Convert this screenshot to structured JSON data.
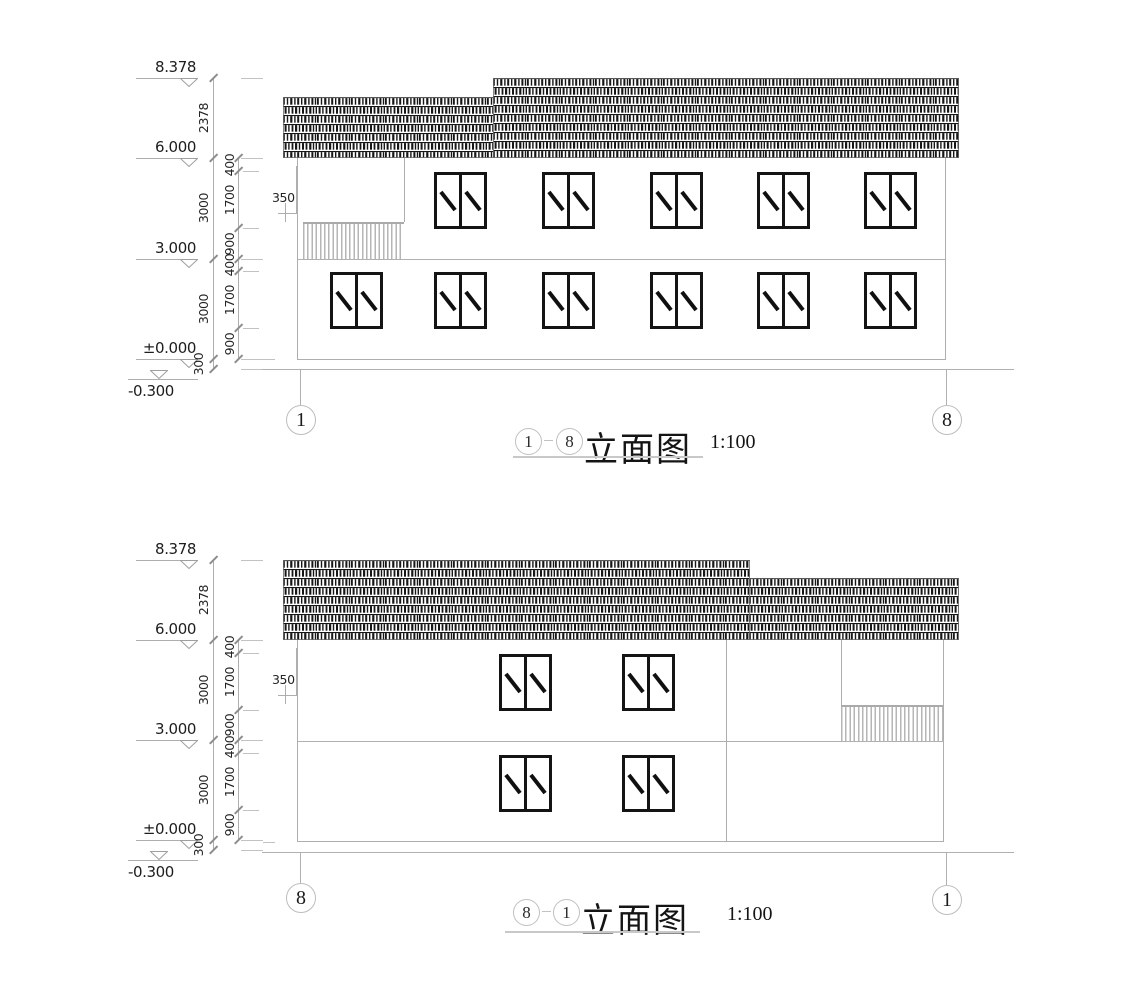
{
  "drawing": {
    "elevations": [
      {
        "title": {
          "bubble_left": "1",
          "bubble_right": "8",
          "label": "立面图",
          "scale": "1:100"
        },
        "axis_bubble_left": "1",
        "axis_bubble_right": "8",
        "levels": [
          "8.378",
          "6.000",
          "3.000",
          "±0.000",
          "-0.300"
        ],
        "overall_dims": [
          "2378",
          "3000",
          "3000",
          "300"
        ],
        "segment_dims": [
          "400",
          "1700",
          "900",
          "400",
          "1700",
          "900"
        ],
        "eave_dim": "350"
      },
      {
        "title": {
          "bubble_left": "8",
          "bubble_right": "1",
          "label": "立面图",
          "scale": "1:100"
        },
        "axis_bubble_left": "8",
        "axis_bubble_right": "1",
        "levels": [
          "8.378",
          "6.000",
          "3.000",
          "±0.000",
          "-0.300"
        ],
        "overall_dims": [
          "2378",
          "3000",
          "3000",
          "300"
        ],
        "segment_dims": [
          "400",
          "1700",
          "900",
          "400",
          "1700",
          "900"
        ],
        "eave_dim": "350"
      }
    ]
  }
}
